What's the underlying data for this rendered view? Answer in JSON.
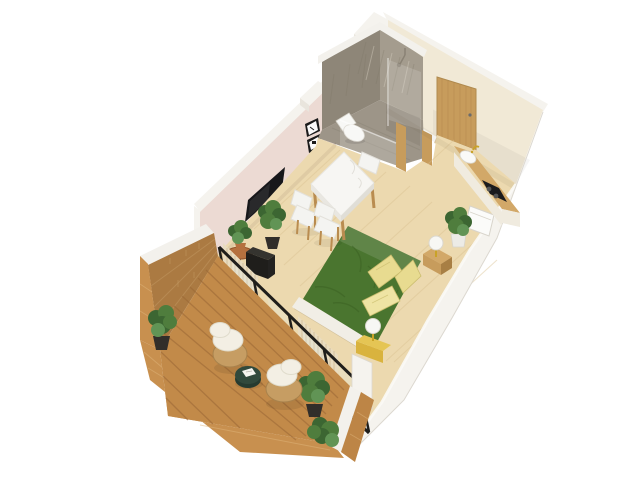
{
  "meta": {
    "title": "3D Isometric Studio Apartment Floor Plan Render",
    "type": "architectural-cutaway-render",
    "background": "#ffffff"
  },
  "palette": {
    "bg": "#ffffff",
    "wall_top": "#f5f3ee",
    "wall_outer": "#e9e5dd",
    "wall_cream": "#f1e9d6",
    "wall_cream_dark": "#e7ddc6",
    "wall_pink": "#ecdad3",
    "wood_floor": "#ecd9af",
    "wood_plank": "#d9c091",
    "wood_door": "#c79c5c",
    "wood_grain": "#b3874a",
    "wood_trim": "#b98c50",
    "wood_side": "#a87f44",
    "counter_wood": "#d2a868",
    "bath_wall": "#a49c8e",
    "bath_wall_dark": "#8e8678",
    "bath_floor": "#9d9588",
    "bath_floor_dark": "#8b8376",
    "white_fixture": "#f7f7f4",
    "bed_green": "#4a752f",
    "bed_green_dark": "#3a5f22",
    "sheet_white": "#f1eee6",
    "pillow_yellow": "#e8db90",
    "pillow_light": "#efe4a4",
    "nightstand_yellow": "#d9b33e",
    "nightstand_yellow_light": "#e5c554",
    "gold": "#c9a227",
    "deck_wood": "#c28a49",
    "deck_slat": "#996634",
    "brick_lit": "#c8904f",
    "brick_shaded": "#ab7a42",
    "brick_mid": "#bd8546",
    "mortar_lit": "#e0b57c",
    "mortar_shaded": "#c39a63",
    "cap_white": "#f3f1ec",
    "wicker": "#c69d63",
    "wicker_dark": "#a8824c",
    "cushion_white": "#f3efe4",
    "table_green": "#31493c",
    "table_green_dark": "#263b30",
    "plant_dark": "#3c6632",
    "plant_mid": "#4f7d3d",
    "plant_light": "#619455",
    "pot_dark": "#312e2a",
    "terracotta": "#b5713f",
    "black": "#1f1e1b",
    "tv_black": "#17171a",
    "frame_black": "#1b1b1b",
    "curtain": "#e9dcc0",
    "curtain_dark": "#d7c6a3",
    "marble_white": "#f7f6f3",
    "marble_edge": "#e9e7e1",
    "marble_edge2": "#e0ded7",
    "chair_white": "#f4f4f1",
    "glass_tint": "#dfeef2"
  },
  "rooms": [
    {
      "id": "bathroom",
      "label": "Bathroom",
      "features": [
        "walk-in-shower",
        "wall-hung-toilet",
        "marble-tiled-walls",
        "glass-door",
        "wood-trim-jambs"
      ]
    },
    {
      "id": "entry",
      "label": "Entry Hall",
      "features": [
        "wooden-front-door"
      ]
    },
    {
      "id": "kitchenette",
      "label": "Kitchenette",
      "features": [
        "wood-countertop",
        "sink-with-gold-faucet",
        "black-cooktop",
        "wall-niche"
      ]
    },
    {
      "id": "living-bedroom",
      "label": "Living / Bedroom",
      "features": [
        "double-bed-green-duvet",
        "three-yellow-pillows",
        "two-nightstands-with-sphere-lamps",
        "marble-dining-table",
        "three-white-chairs",
        "wall-mounted-tv",
        "three-gallery-frames",
        "black-sideboard",
        "plant-stool",
        "potted-plants",
        "beige-curtains"
      ]
    },
    {
      "id": "balcony",
      "label": "Balcony",
      "features": [
        "brick-parapet-walls",
        "wood-slat-deck",
        "two-wicker-armchairs",
        "round-green-coffee-table",
        "magazine",
        "potted-shrubs",
        "black-framed-glazing"
      ]
    }
  ]
}
